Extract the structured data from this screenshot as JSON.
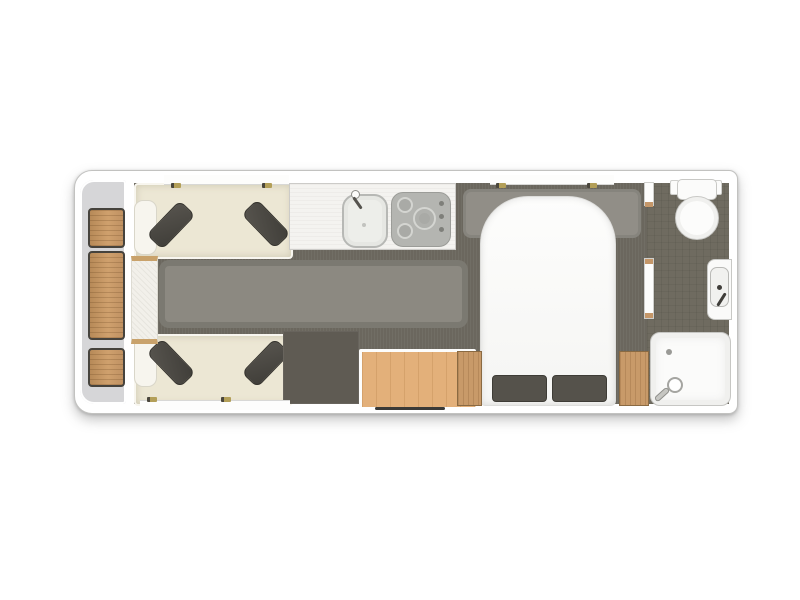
{
  "document": {
    "type": "caravan-floor-plan",
    "background_color": "#ffffff",
    "orientation": "side-on, front of caravan at left, washroom at rear right"
  },
  "palette": {
    "shell_white": "#ffffff",
    "front_zone_gray": "#d6d6d8",
    "floor_olive": "#6b675e",
    "washroom_floor": "#6f6b60",
    "carpet_gray": "#8c8981",
    "rug_gray": "#918e87",
    "sofa_cream": "#ece7d4",
    "cushion_dark": "#4c4944",
    "wood_tan": "#c89a69",
    "sideboard_wood": "#e3b07a",
    "counter_white": "#f4f3f0",
    "hob_gray": "#b4b5b1",
    "fixture_white": "#fbfbfa",
    "fixture_outline": "#c8c8c5",
    "door_marker_dark": "#3b3a37",
    "hinge_gold": "#b39f58"
  },
  "rooms": {
    "front_storage": {
      "label": "Front lockers",
      "locker_count": 3
    },
    "lounge": {
      "label": "Lounge",
      "sofas": 2,
      "cushions_per_sofa": 2,
      "table_label": "Chest / occasional table",
      "carpet_label": "Centre carpet runner"
    },
    "kitchen": {
      "label": "Kitchen",
      "sink_label": "Sink with tap",
      "hob_label": "Hob with 3 burners and 3 control knobs",
      "worktop_label": "Worktop"
    },
    "mid": {
      "wardrobe_label": "Wardrobe / dark unit",
      "sideboard_label": "Wooden sideboard",
      "door_label": "Entrance door (bottom wall)"
    },
    "bedroom": {
      "label": "Bedroom",
      "bed_label": "Island bed",
      "pillows": 2,
      "bedside_cabinets": 2,
      "rug_label": "Bed-head rug"
    },
    "washroom": {
      "label": "Rear washroom",
      "toilet_label": "Toilet with cistern",
      "basin_label": "Washbasin",
      "shower_label": "Shower tray"
    },
    "windows": {
      "count": 3,
      "positions": [
        "lounge top wall",
        "bedroom top wall",
        "lounge bottom wall"
      ],
      "hinges_per_window": 2
    }
  }
}
